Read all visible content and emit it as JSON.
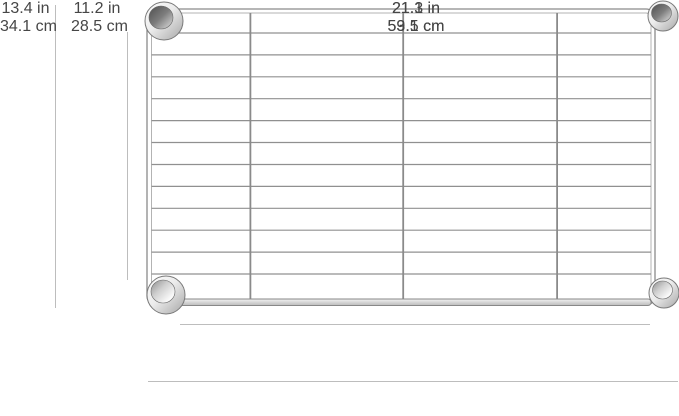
{
  "diagram": {
    "description": "Chrome wire shelf with dimension callouts",
    "dimension_labels": {
      "outer_height": {
        "inches": "13.4 in",
        "metric": "34.1 cm"
      },
      "shelf_height": {
        "inches": "11.2 in",
        "metric": "28.5 cm"
      },
      "shelf_width": {
        "inches": "21.1 in",
        "metric": "53.5 cm"
      },
      "outer_width": {
        "inches": "21.3 in",
        "metric": "59.1 cm"
      }
    },
    "grid": {
      "rows": 13,
      "columns": 4,
      "column_fractions": [
        0.198,
        0.504,
        0.812
      ]
    },
    "colors": {
      "background": "#ffffff",
      "wire": "#8f8f8f",
      "frame": "#8a8a8a",
      "dimension_line": "#bdbdbd",
      "label_text": "#464646"
    }
  }
}
